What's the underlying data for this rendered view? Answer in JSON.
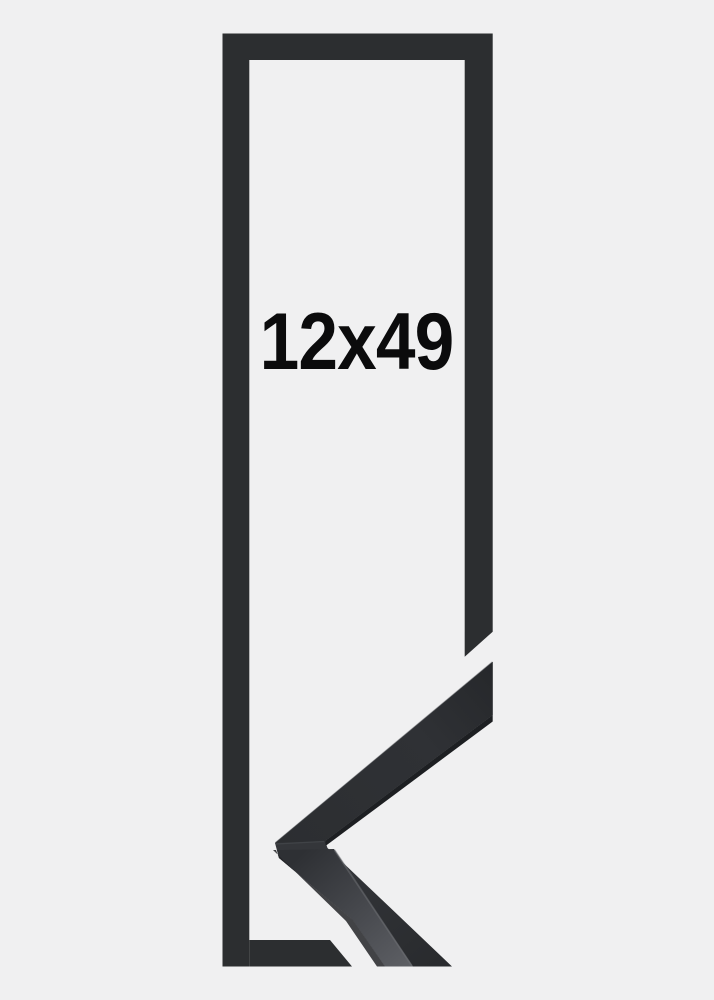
{
  "product_image": {
    "size_label": "12x49",
    "colors": {
      "background": "#f0f0f1",
      "frame_flat": "#2c2e30",
      "corner_face_end": "#26282b",
      "corner_face_mid": "#2f3135",
      "corner_face_corner": "#2c2e31",
      "corner_lower_top": "#34363a",
      "corner_lower_bottom": "#292b2e",
      "side_strip_top": "#2e3034",
      "side_strip_mid": "#4a4c51",
      "side_strip_bottom": "#5d5f64",
      "inner_edge_dark": "#1d1f22",
      "label": "#0b0b0c"
    }
  }
}
